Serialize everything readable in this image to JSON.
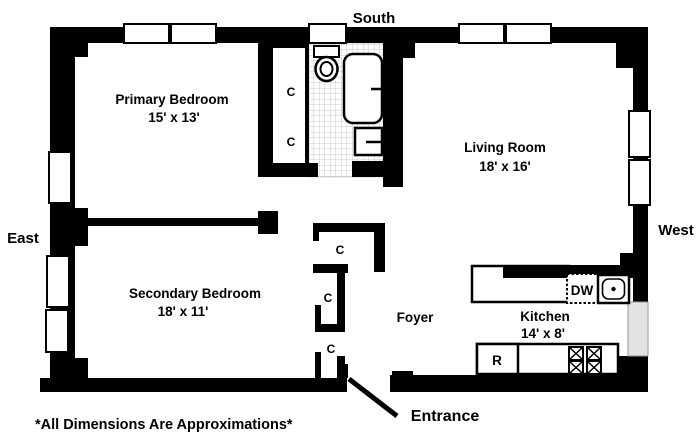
{
  "plan": {
    "compass": {
      "south": "South",
      "east": "East",
      "west": "West"
    },
    "rooms": {
      "primary_bedroom": {
        "name": "Primary Bedroom",
        "dims": "15' x 13'"
      },
      "secondary_bedroom": {
        "name": "Secondary Bedroom",
        "dims": "18' x 11'"
      },
      "living_room": {
        "name": "Living Room",
        "dims": "18' x 16'"
      },
      "kitchen": {
        "name": "Kitchen",
        "dims": "14' x 8'"
      },
      "foyer": {
        "name": "Foyer"
      }
    },
    "closet_label": "C",
    "appliances": {
      "dishwasher": "DW",
      "refrigerator": "R"
    },
    "entrance_label": "Entrance",
    "disclaimer": "*All Dimensions Are Approximations*",
    "colors": {
      "wall": "#000000",
      "floor": "#ffffff",
      "tile_line": "#c8c8c8",
      "window_fill": "#ffffff",
      "recessed_window_fill": "#e3e3e3"
    }
  }
}
